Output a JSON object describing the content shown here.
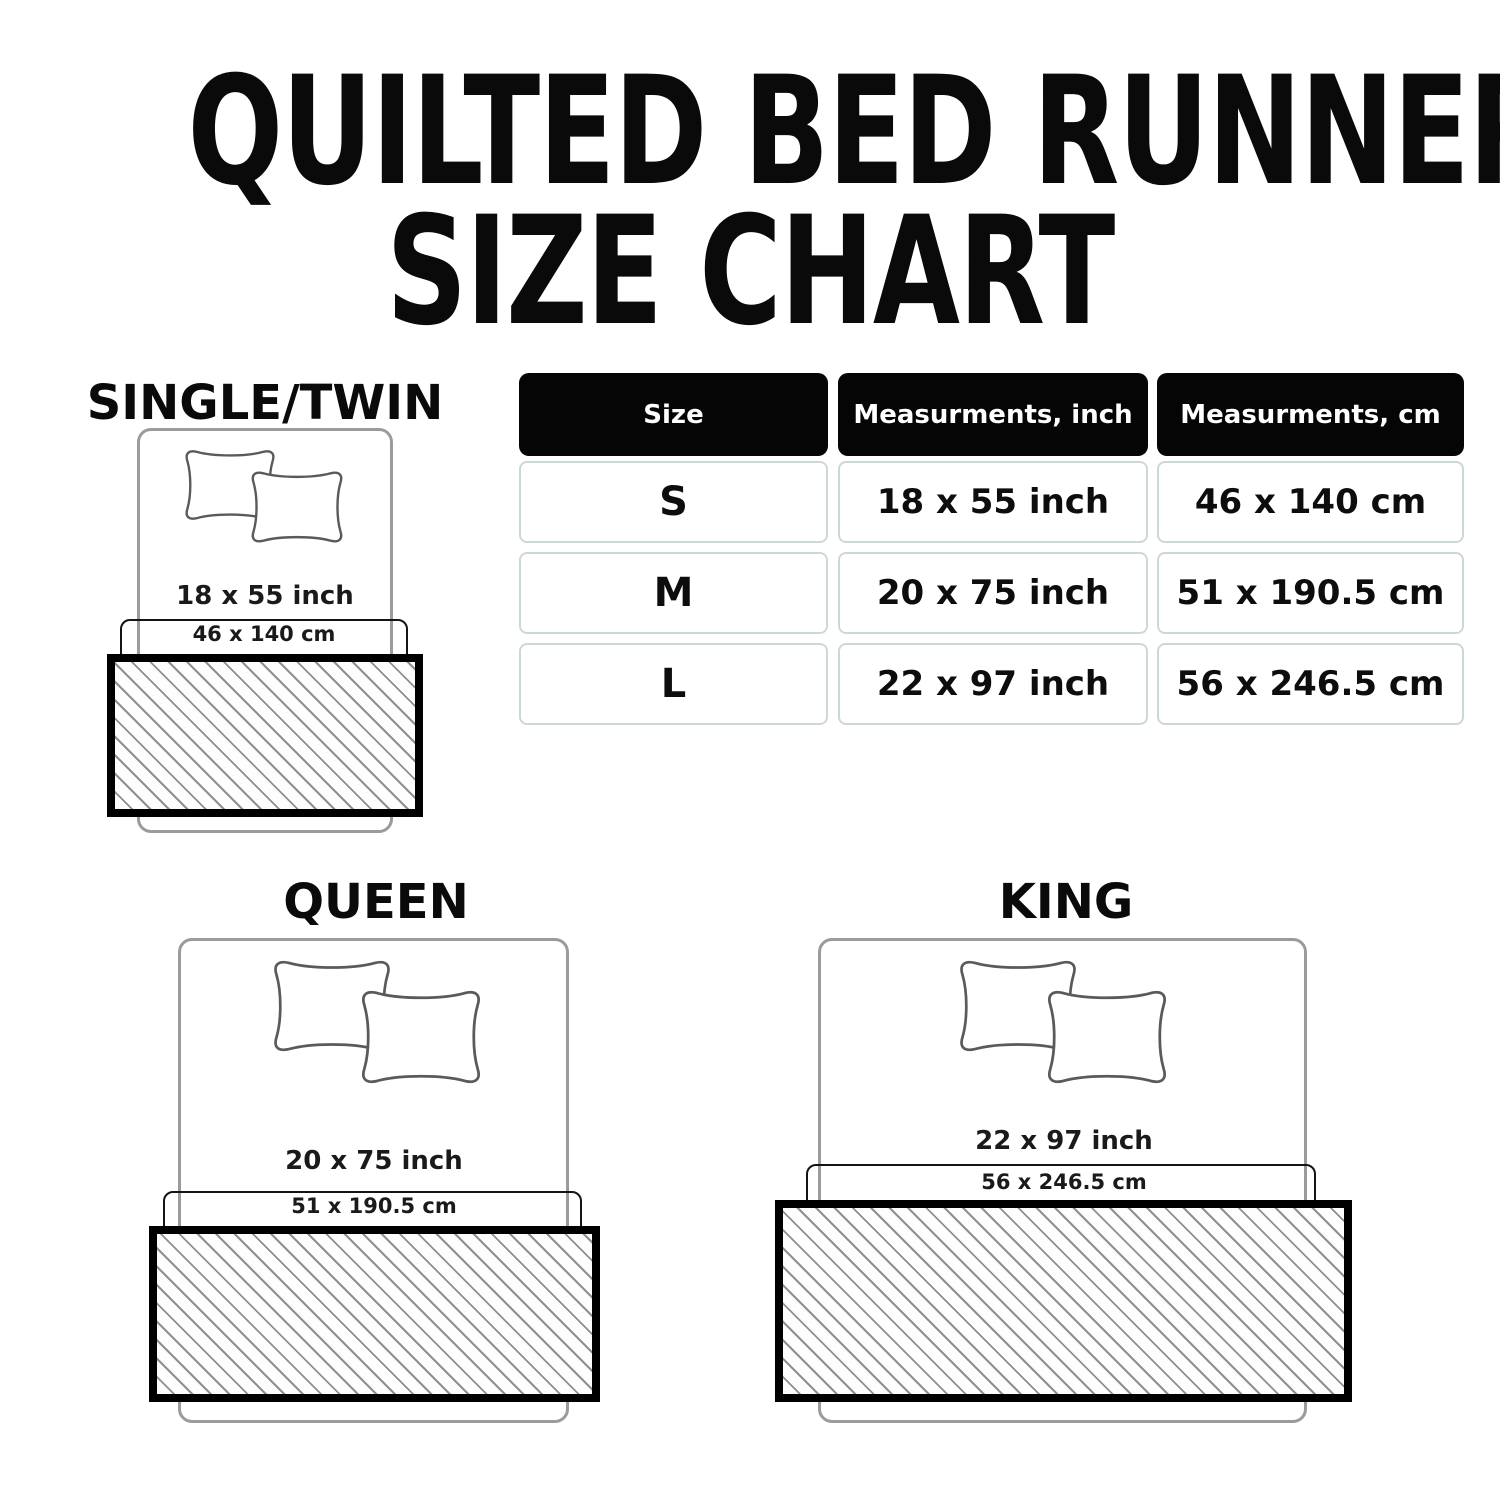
{
  "title": {
    "line1": "QUILTED BED RUNNER",
    "line2": "SIZE CHART"
  },
  "table": {
    "headers": [
      "Size",
      "Measurments, inch",
      "Measurments, cm"
    ],
    "rows": [
      {
        "size": "S",
        "inch": "18 x 55 inch",
        "cm": "46 x 140 cm"
      },
      {
        "size": "M",
        "inch": "20 x 75 inch",
        "cm": "51 x 190.5 cm"
      },
      {
        "size": "L",
        "inch": "22 x 97 inch",
        "cm": "56 x 246.5 cm"
      }
    ]
  },
  "diagrams": [
    {
      "name": "SINGLE/TWIN",
      "inch": "18 x 55 inch",
      "cm": "46 x 140 cm"
    },
    {
      "name": "QUEEN",
      "inch": "20 x 75 inch",
      "cm": "51 x 190.5 cm"
    },
    {
      "name": "KING",
      "inch": "22 x 97 inch",
      "cm": "56 x 246.5 cm"
    }
  ],
  "colors": {
    "background": "#ffffff",
    "text": "#0a0a0a",
    "header_cell_bg": "#050505",
    "header_cell_text": "#ffffff",
    "body_cell_border": "#ccd7da",
    "bed_outline": "#9b9b9b",
    "pillow_outline": "#5a5a5a",
    "bracket_outline": "#141414",
    "runner_border": "#000000",
    "hatch_line": "#8f8f8f"
  }
}
